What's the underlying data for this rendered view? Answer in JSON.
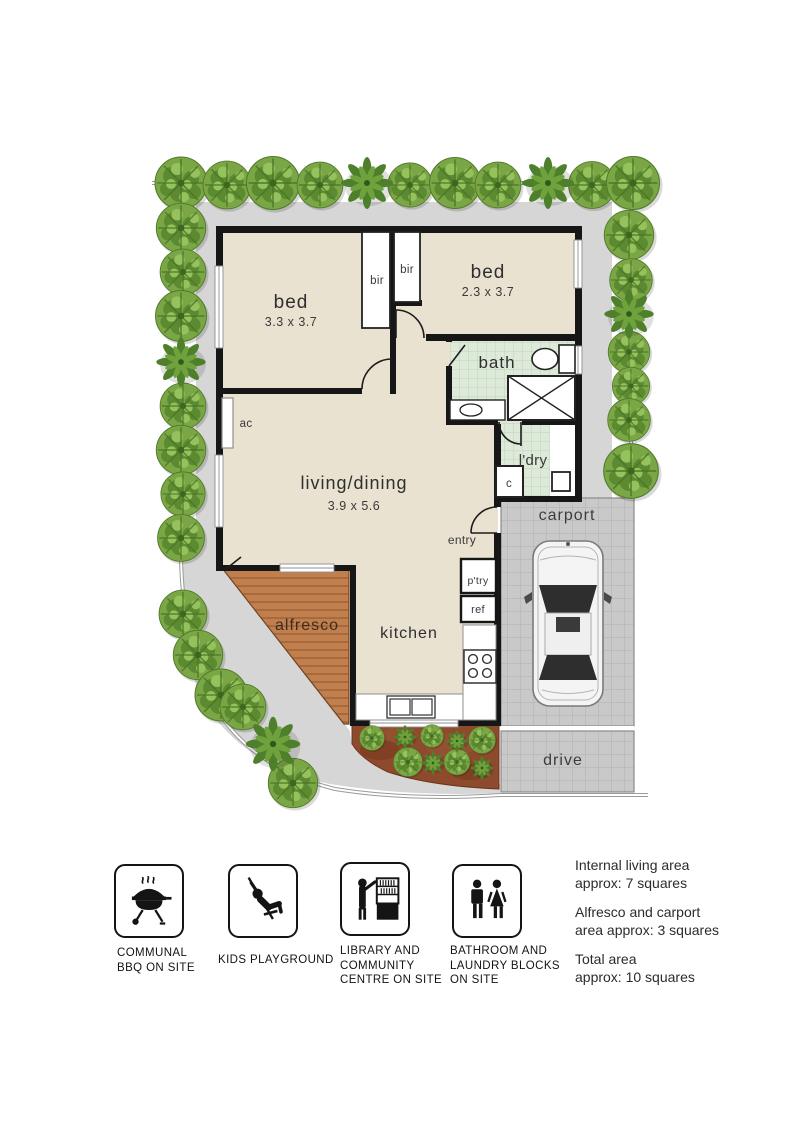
{
  "plan": {
    "rooms": {
      "bed1": {
        "label": "bed",
        "dims": "3.3 x 3.7"
      },
      "bed2": {
        "label": "bed",
        "dims": "2.3 x 3.7"
      },
      "living": {
        "label": "living/dining",
        "dims": "3.9 x 5.6"
      },
      "bath": {
        "label": "bath"
      },
      "laundry": {
        "label": "l'dry"
      },
      "kitchen": {
        "label": "kitchen"
      },
      "alfresco": {
        "label": "alfresco"
      },
      "carport": {
        "label": "carport"
      },
      "drive": {
        "label": "drive"
      },
      "entry": {
        "label": "entry"
      }
    },
    "fixtures": {
      "bir_left": "bir",
      "bir_right": "bir",
      "ac": "ac",
      "closet": "c",
      "pantry": "p'try",
      "fridge": "ref"
    }
  },
  "legend": {
    "items": [
      {
        "icon": "bbq-icon",
        "lines": [
          "COMMUNAL",
          "BBQ ON SITE"
        ]
      },
      {
        "icon": "kids-playground-icon",
        "lines": [
          "KIDS PLAYGROUND"
        ]
      },
      {
        "icon": "library-icon",
        "lines": [
          "LIBRARY AND",
          "COMMUNITY",
          "CENTRE ON SITE"
        ]
      },
      {
        "icon": "bathroom-laundry-icon",
        "lines": [
          "BATHROOM AND",
          "LAUNDRY BLOCKS",
          "ON SITE"
        ]
      }
    ]
  },
  "areas": [
    {
      "line1": "Internal living area",
      "line2": "approx: 7 squares"
    },
    {
      "line1": "Alfresco and carport",
      "line2": "area approx: 3 squares"
    },
    {
      "line1": "Total area",
      "line2": "approx: 10 squares"
    }
  ],
  "colors": {
    "floor": "#e9e2d1",
    "wall": "#161616",
    "tiles": "#dde9d9",
    "alfresco": "#c17f4e",
    "paving": "#c9c9c9",
    "path": "#d6d6d6",
    "garden": "#8d4a2c",
    "tree": "#76a441"
  }
}
